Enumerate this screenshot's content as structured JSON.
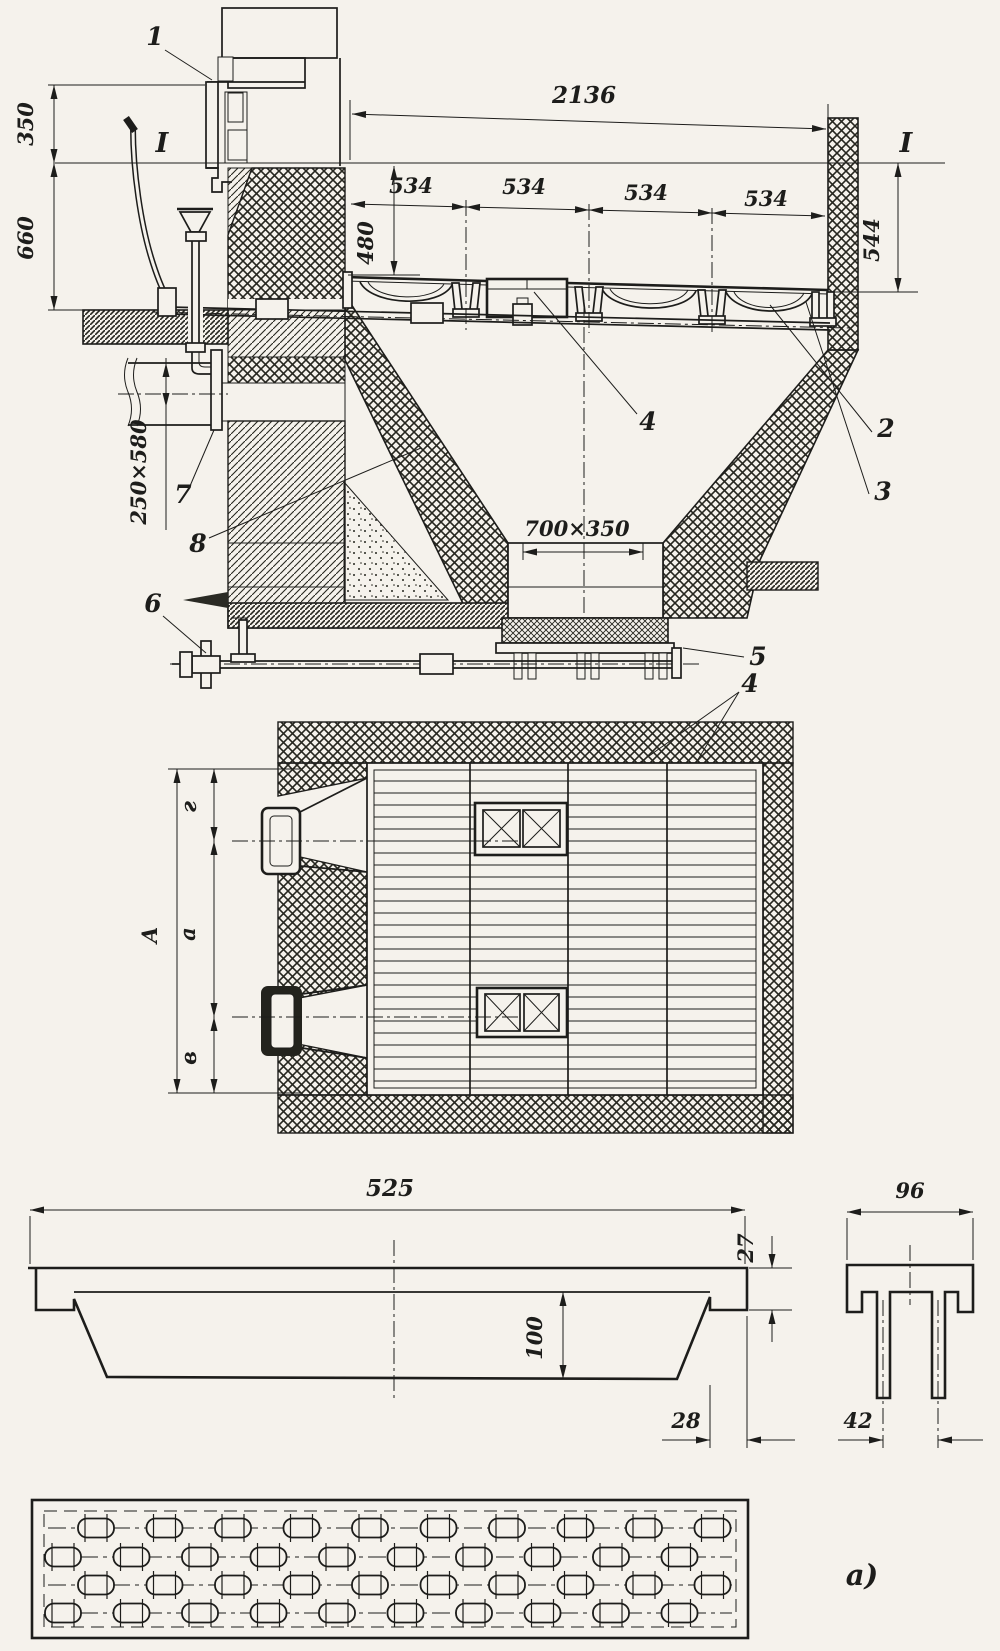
{
  "section": {
    "dim_350": "350",
    "dim_660": "660",
    "dim_2136": "2136",
    "dim_534_1": "534",
    "dim_534_2": "534",
    "dim_534_3": "534",
    "dim_534_4": "534",
    "dim_480": "480",
    "dim_544": "544",
    "dim_250x580": "250×580",
    "dim_700x350": "700×350",
    "mark_I_left": "I",
    "mark_I_right": "I",
    "callout_1": "1",
    "callout_2": "2",
    "callout_3": "3",
    "callout_4": "4",
    "callout_4_plan": "4",
    "callout_5": "5",
    "callout_6": "6",
    "callout_7": "7",
    "callout_8": "8"
  },
  "plan": {
    "dim_A": "A",
    "dim_g": "г",
    "dim_a": "a",
    "dim_v": "в"
  },
  "bar_detail": {
    "dim_525": "525",
    "dim_27": "27",
    "dim_100": "100",
    "dim_28": "28",
    "dim_96": "96",
    "dim_42": "42",
    "label_a": "а)"
  }
}
